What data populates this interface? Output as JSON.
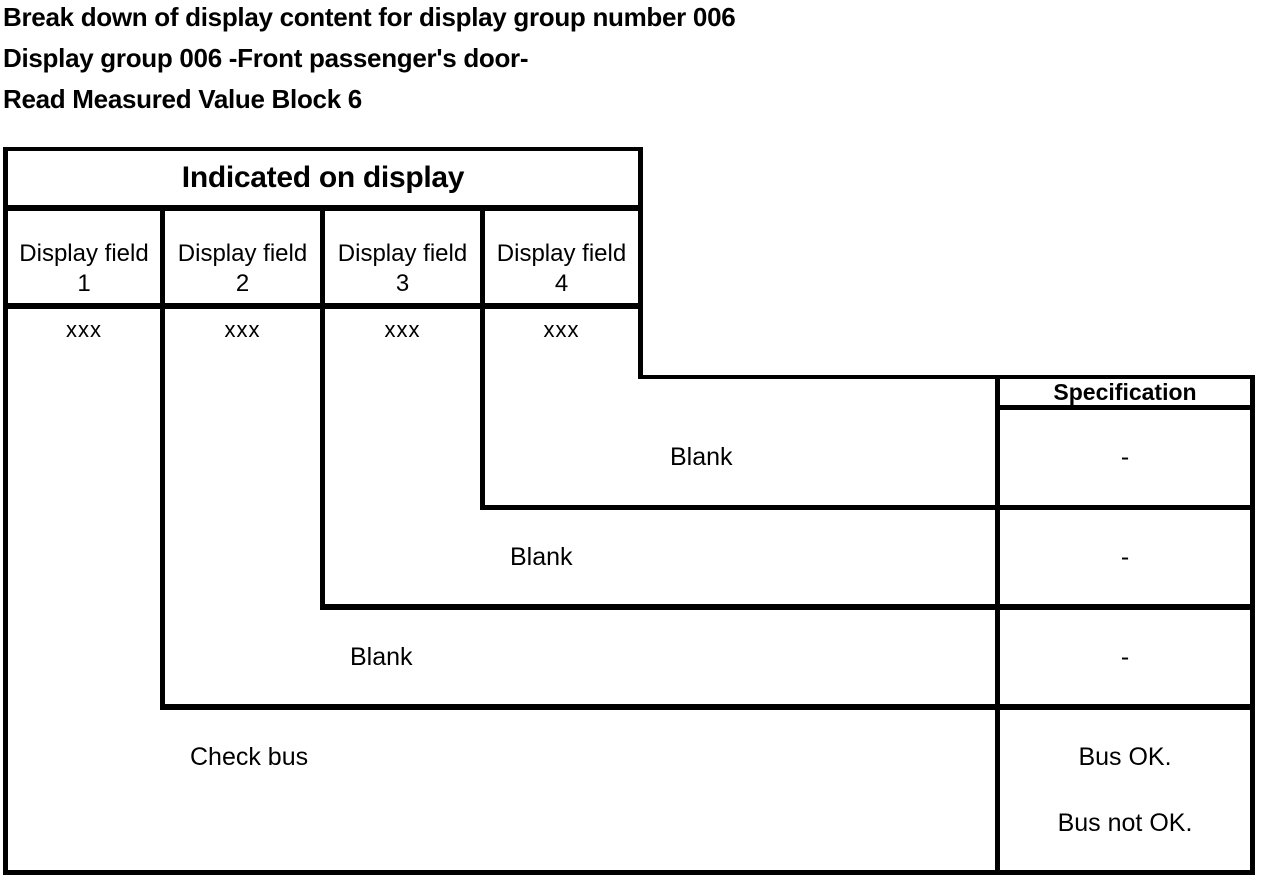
{
  "title": {
    "line1": "Break down of display content for display group number 006",
    "line2": "Display group 006 -Front passenger's door-",
    "line3": "Read Measured Value Block 6"
  },
  "table": {
    "indicated_header": "Indicated on display",
    "spec_header": "Specification",
    "fields": [
      {
        "label": "Display field",
        "number": "1",
        "value": "xxx"
      },
      {
        "label": "Display field",
        "number": "2",
        "value": "xxx"
      },
      {
        "label": "Display field",
        "number": "3",
        "value": "xxx"
      },
      {
        "label": "Display field",
        "number": "4",
        "value": "xxx"
      }
    ],
    "rows": [
      {
        "display_field": "4",
        "content": "Blank",
        "specification": "-"
      },
      {
        "display_field": "3",
        "content": "Blank",
        "specification": "-"
      },
      {
        "display_field": "2",
        "content": "Blank",
        "specification": "-"
      },
      {
        "display_field": "1",
        "content": "Check bus",
        "specification": "Bus OK.",
        "specification_alt": "Bus not OK."
      }
    ]
  }
}
